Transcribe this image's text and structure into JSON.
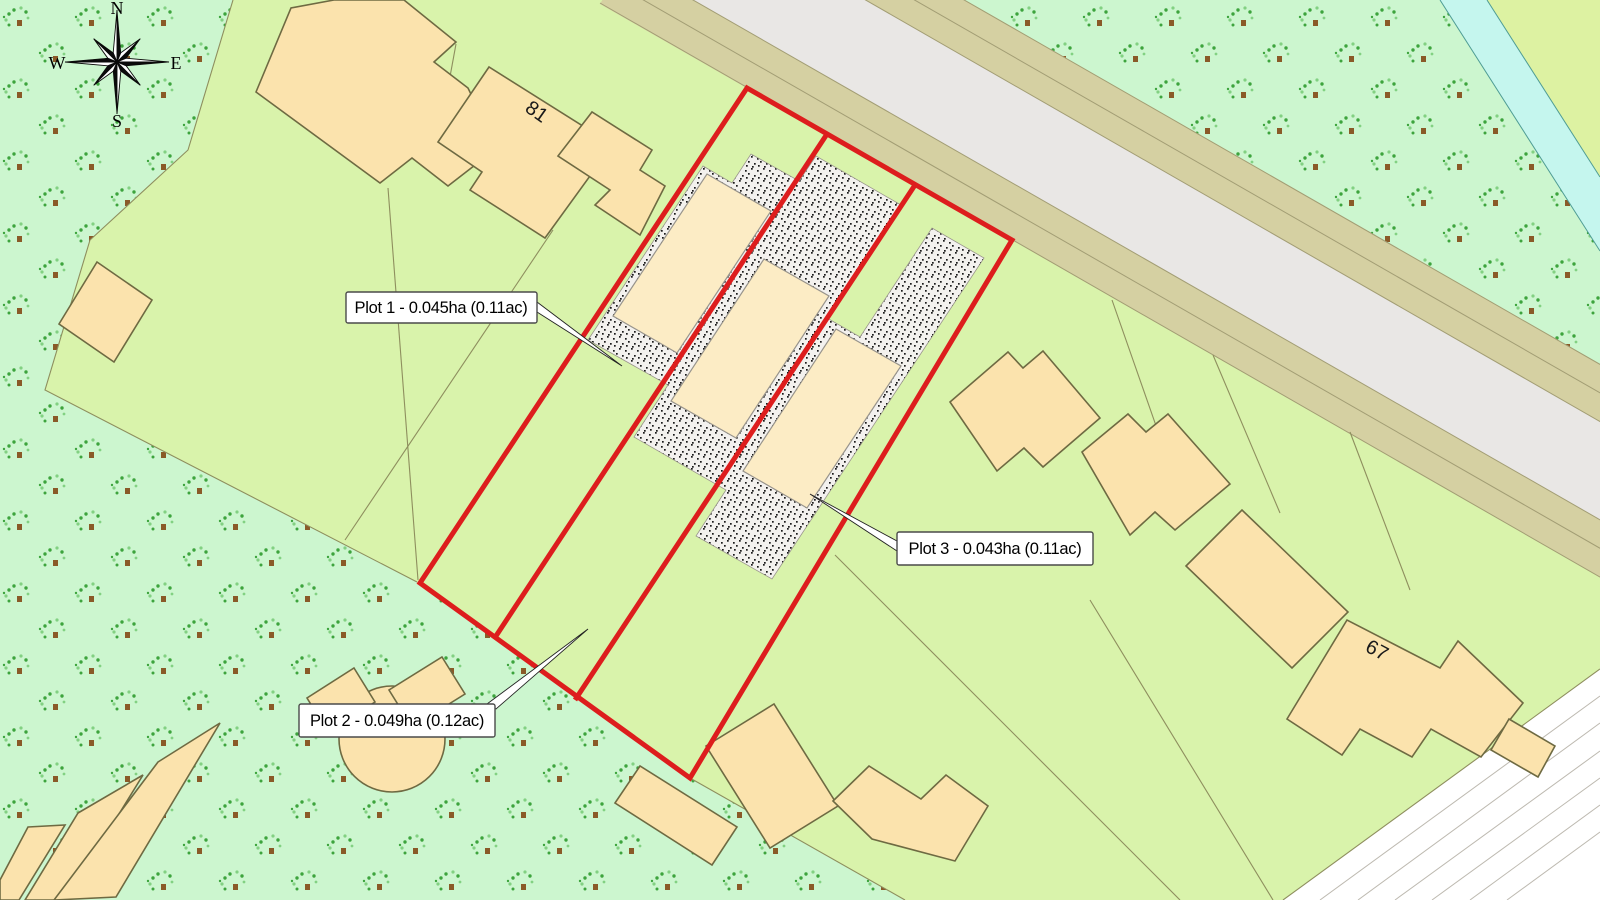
{
  "map": {
    "type": "residential development site plan",
    "compass": {
      "north": "N",
      "east": "E",
      "south": "S",
      "west": "W"
    },
    "plots": [
      {
        "id": "plot-1",
        "label": "Plot 1 - 0.045ha (0.11ac)",
        "area_ha": 0.045,
        "area_ac": 0.11
      },
      {
        "id": "plot-2",
        "label": "Plot 2 - 0.049ha (0.12ac)",
        "area_ha": 0.049,
        "area_ac": 0.12
      },
      {
        "id": "plot-3",
        "label": "Plot 3 - 0.043ha (0.11ac)",
        "area_ha": 0.043,
        "area_ac": 0.11
      }
    ],
    "house_numbers": {
      "north_house": "81",
      "southeast_house": "67"
    },
    "colors": {
      "plot_red": "#dd1d1d",
      "field": "#d9f3ab",
      "field2": "#ddf2a2",
      "orchard": "#ccf6cf",
      "building_fill": "#fbe3ad",
      "building_stroke": "#6e6a42",
      "proposed_fill": "#fcecc5",
      "road_verge": "#d5d0a2",
      "carriageway": "#e9e7e5",
      "water": "#c5f6ee"
    }
  }
}
